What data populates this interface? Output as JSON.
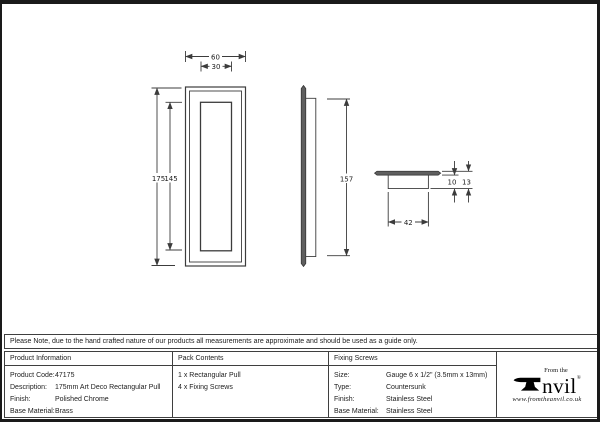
{
  "drawing": {
    "dims": {
      "front_outer_width": "60",
      "front_inner_width": "30",
      "front_outer_height": "175",
      "front_inner_height": "145",
      "side_height": "157",
      "plan_width": "42",
      "plan_inner_depth": "10",
      "plan_total_depth": "13"
    }
  },
  "note": {
    "text": "Please Note, due to the hand crafted nature of our products all measurements are approximate and should be used as a guide only."
  },
  "table": {
    "product_information": {
      "header": "Product Information",
      "rows": [
        {
          "label": "Product Code:",
          "value": "47175"
        },
        {
          "label": "Description:",
          "value": "175mm Art Deco Rectangular Pull"
        },
        {
          "label": "Finish:",
          "value": "Polished Chrome"
        },
        {
          "label": "Base Material:",
          "value": "Brass"
        }
      ]
    },
    "pack_contents": {
      "header": "Pack Contents",
      "items": [
        "1 x Rectangular Pull",
        "4 x Fixing Screws"
      ]
    },
    "fixing_screws": {
      "header": "Fixing Screws",
      "rows": [
        {
          "label": "Size:",
          "value": "Gauge 6 x 1/2\" (3.5mm x 13mm)"
        },
        {
          "label": "Type:",
          "value": "Countersunk"
        },
        {
          "label": "Finish:",
          "value": "Stainless Steel"
        },
        {
          "label": "Base Material:",
          "value": "Stainless Steel"
        }
      ]
    }
  },
  "brand": {
    "prefix": "From the",
    "name_rest": "nvil",
    "registered": "®",
    "website": "www.fromtheanvil.co.uk"
  }
}
